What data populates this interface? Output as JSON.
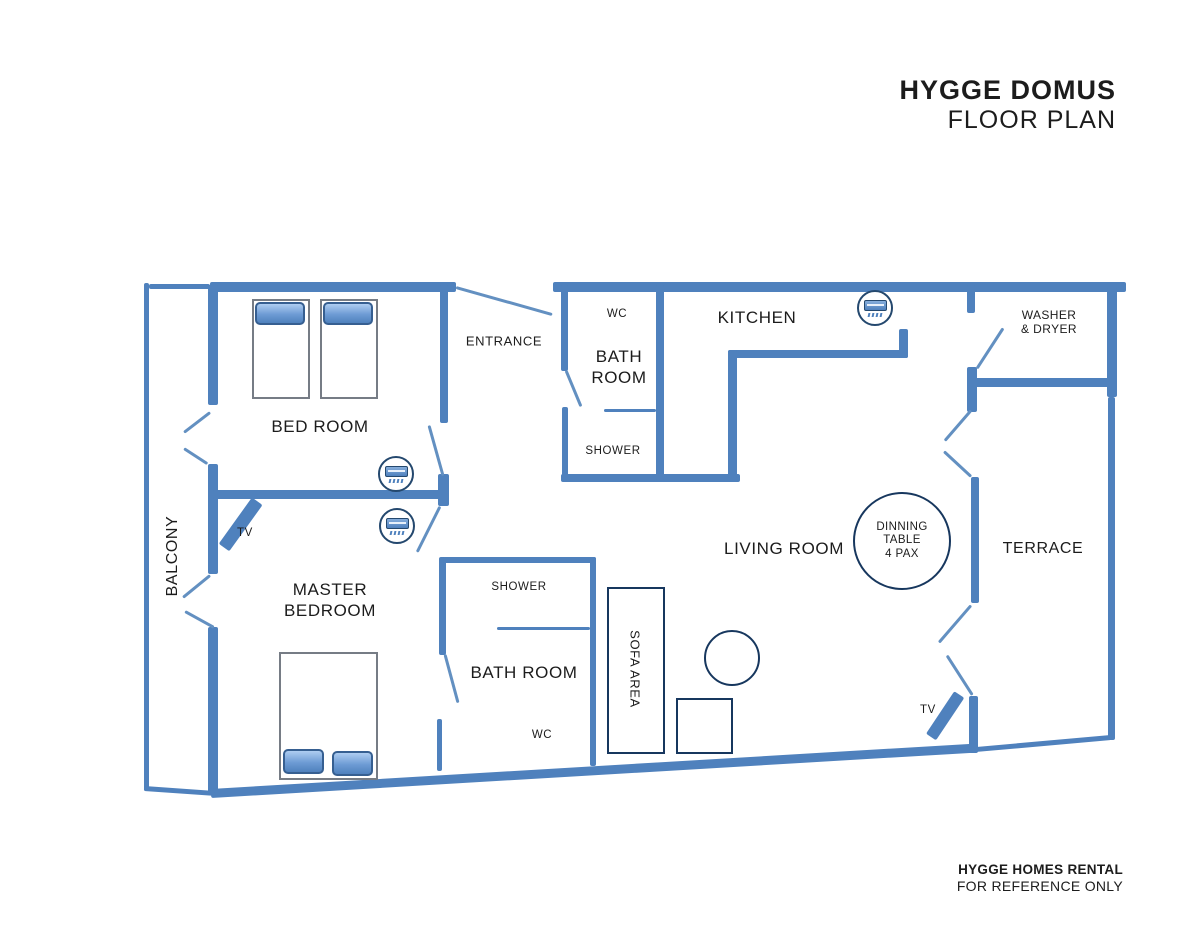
{
  "header": {
    "title": "HYGGE DOMUS",
    "subtitle": "FLOOR PLAN"
  },
  "footer": {
    "line1": "HYGGE HOMES RENTAL",
    "line2": "FOR REFERENCE ONLY"
  },
  "rooms": {
    "balcony": "BALCONY",
    "bedroom": "BED ROOM",
    "master_line1": "MASTER",
    "master_line2": "BEDROOM",
    "entrance": "ENTRANCE",
    "kitchen": "KITCHEN",
    "living": "LIVING ROOM",
    "terrace": "TERRACE",
    "washer_line1": "WASHER",
    "washer_line2": "& DRYER",
    "sofa": "SOFA AREA",
    "bath1_line1": "BATH",
    "bath1_line2": "ROOM",
    "bath1_wc": "WC",
    "bath1_shower": "SHOWER",
    "bath2": "BATH ROOM",
    "bath2_wc": "WC",
    "bath2_shower": "SHOWER"
  },
  "furniture": {
    "dining_line1": "DINNING",
    "dining_line2": "TABLE",
    "dining_line3": "4 PAX",
    "tv_master": "TV",
    "tv_living": "TV"
  },
  "icons": [
    {
      "name": "ac-unit-icon",
      "location": "bedroom"
    },
    {
      "name": "ac-unit-icon",
      "location": "master-bedroom"
    },
    {
      "name": "ac-unit-icon",
      "location": "kitchen"
    }
  ],
  "colors": {
    "wall": "#4f81bd",
    "furniture_outline": "#17375e",
    "text": "#1c1c1c"
  }
}
